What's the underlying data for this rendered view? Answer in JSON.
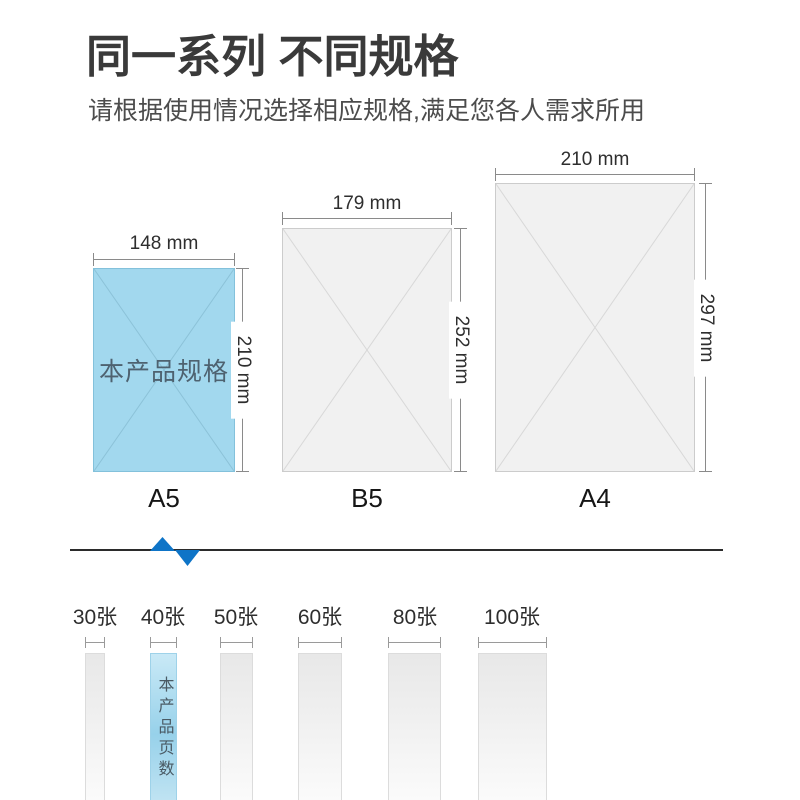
{
  "header": {
    "title": "同一系列 不同规格",
    "subtitle": "请根据使用情况选择相应规格,满足您各人需求所用"
  },
  "papers": [
    {
      "name": "A5",
      "width_label": "148 mm",
      "height_label": "210 mm",
      "note": "本产品规格",
      "highlighted": true
    },
    {
      "name": "B5",
      "width_label": "179 mm",
      "height_label": "252 mm",
      "highlighted": false
    },
    {
      "name": "A4",
      "width_label": "210 mm",
      "height_label": "297 mm",
      "highlighted": false
    }
  ],
  "sheet_counts": [
    {
      "label": "30张",
      "highlighted": false
    },
    {
      "label": "40张",
      "highlighted": true,
      "note": "本产品页数"
    },
    {
      "label": "50张",
      "highlighted": false
    },
    {
      "label": "60张",
      "highlighted": false
    },
    {
      "label": "80张",
      "highlighted": false
    },
    {
      "label": "100张",
      "highlighted": false
    }
  ],
  "icons": {
    "pointer_marker": "up-down-triangle-zigzag"
  },
  "colors": {
    "highlight_paper_fill": "#a2d8ee",
    "paper_gray_fill": "#f1f1f1",
    "accent_blue": "#0e74c7",
    "divider_line": "#2b2b2b",
    "highlight_bar_top": "#c9e9f6",
    "highlight_bar_bottom": "#8ccbe6",
    "title_text": "#3a3a3a"
  }
}
